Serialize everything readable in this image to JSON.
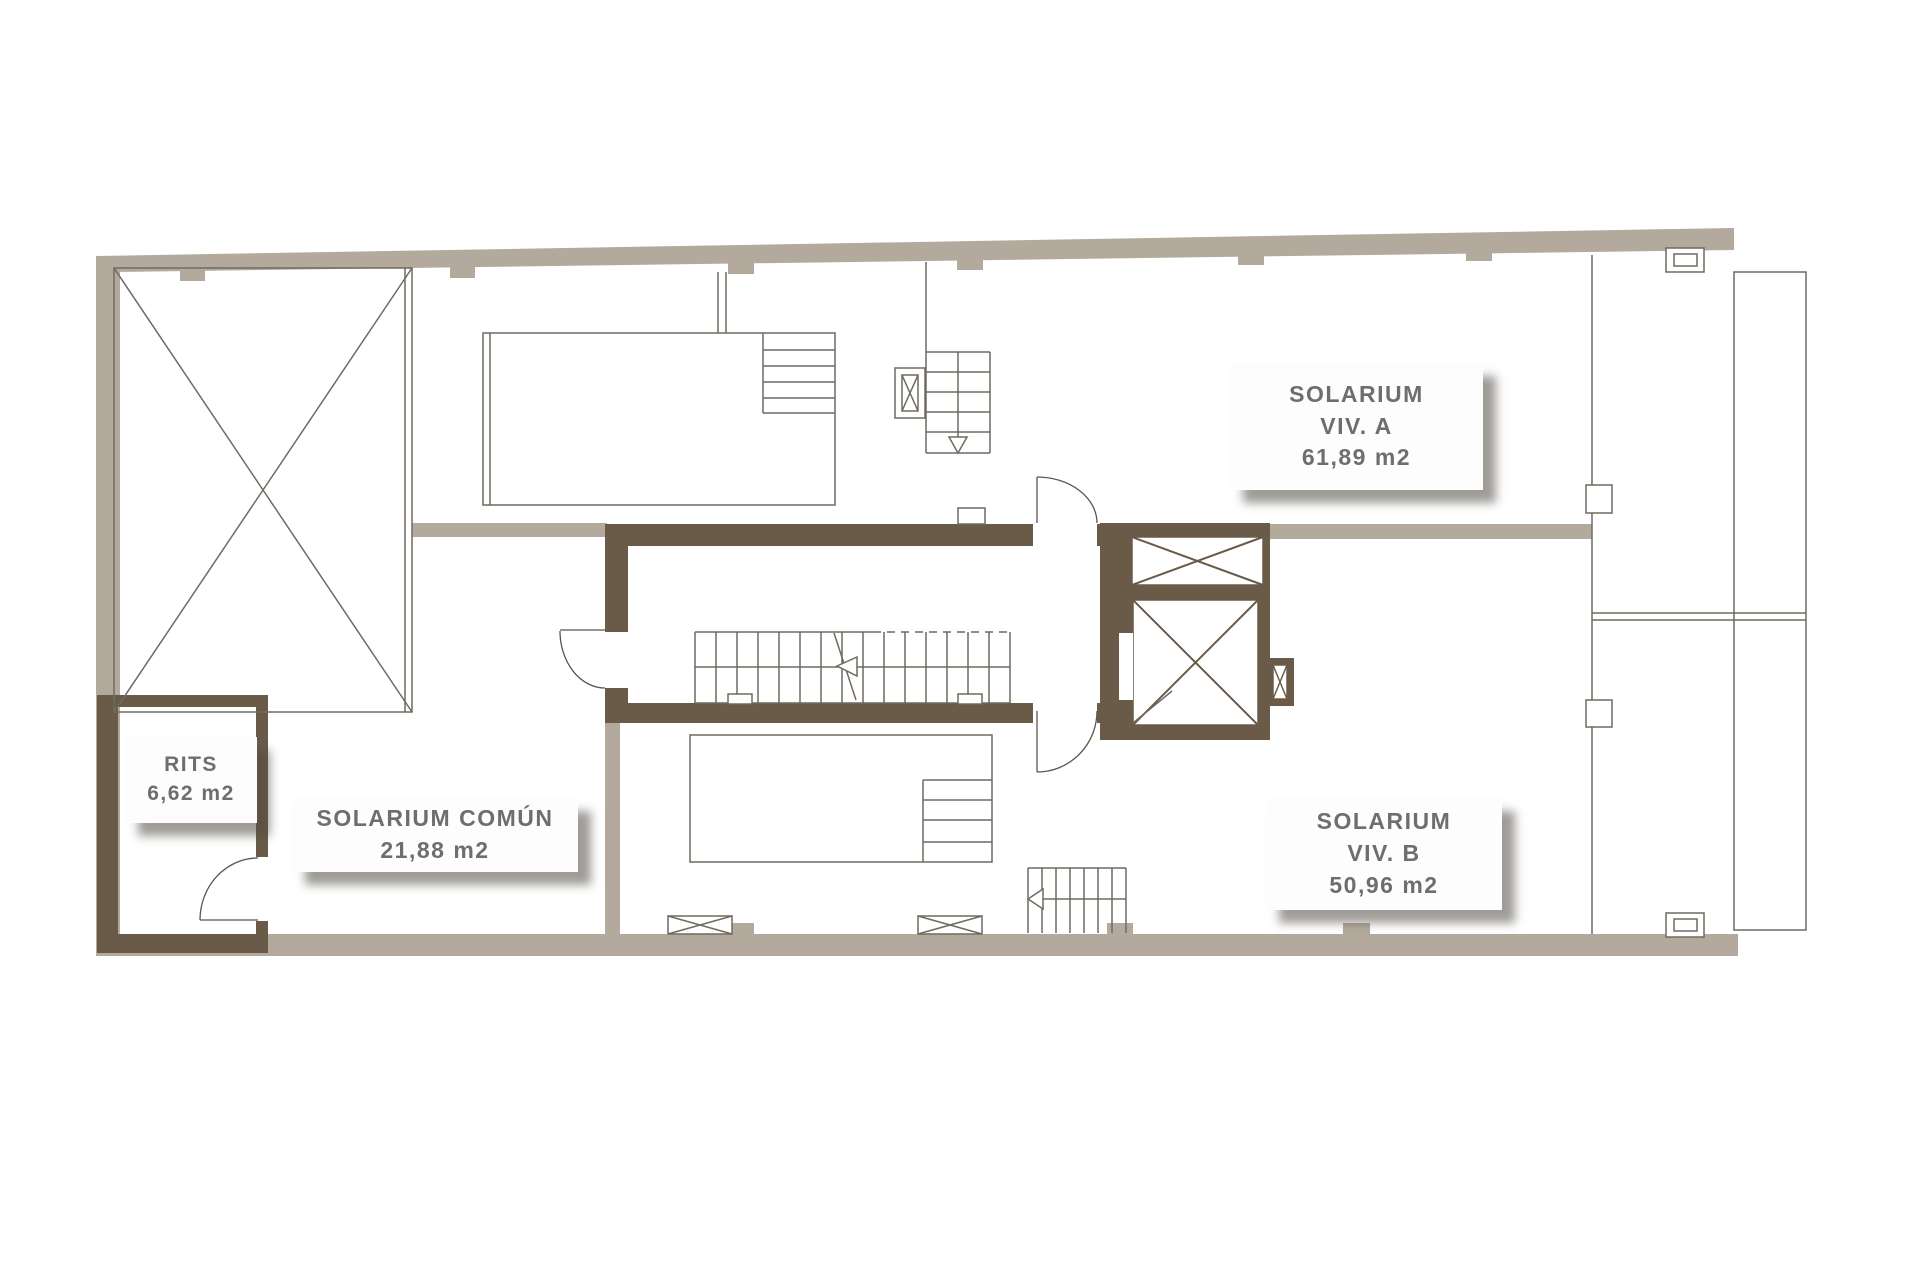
{
  "plan": {
    "labels": {
      "solarium_a": {
        "line1": "SOLARIUM",
        "line2": "VIV. A",
        "line3": "61,89 m2"
      },
      "solarium_b": {
        "line1": "SOLARIUM",
        "line2": "VIV. B",
        "line3": "50,96 m2"
      },
      "solarium_comun": {
        "line1": "SOLARIUM COMÚN",
        "line2": "21,88 m2"
      },
      "rits": {
        "line1": "RITS",
        "line2": "6,62 m2"
      }
    },
    "colors": {
      "background": "#ffffff",
      "wall_light": "#b3a99c",
      "wall_dark": "#6a5b49",
      "line": "#6f6a60",
      "label_text": "#6e6e6e"
    }
  }
}
